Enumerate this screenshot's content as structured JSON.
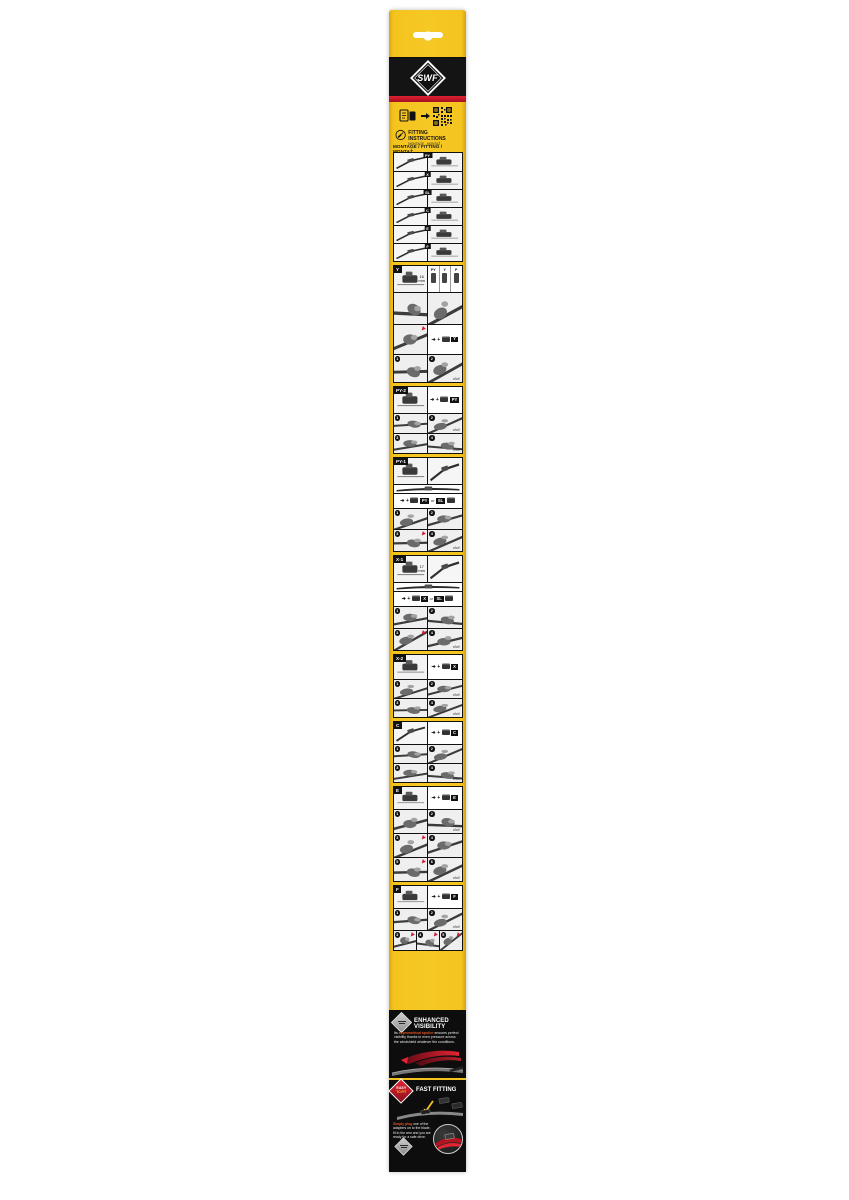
{
  "brand": "SWF",
  "colors": {
    "yellow": "#F4C41E",
    "red": "#D21E2E",
    "black": "#141414",
    "orange_highlight": "#E8541D"
  },
  "top": {
    "fitting_instructions": "FITTING INSTRUCTIONS",
    "fitting_sub": "MONTAGE - MONTAŽ",
    "heading": "MONTAGE / FITTING / MONTAŽ"
  },
  "misc": {
    "or": "or",
    "mm": "mm",
    "click": "click!",
    "plus": "+",
    "arrow": "➔"
  },
  "overview": [
    "PY",
    "X",
    "SL",
    "C",
    "E",
    "F"
  ],
  "compare": [
    "PY",
    "Y",
    "P"
  ],
  "blocks": [
    {
      "label": "Y",
      "rows": [
        {
          "h": 26,
          "cells": [
            {
              "k": "ruler",
              "num": "16"
            },
            {
              "k": "compare"
            }
          ]
        },
        {
          "h": 32,
          "cells": [
            {
              "k": "photo"
            },
            {
              "k": "photo"
            }
          ]
        },
        {
          "h": 30,
          "cells": [
            {
              "k": "photo",
              "warn": true
            },
            {
              "k": "formula",
              "main": "Y"
            }
          ]
        },
        {
          "h": 28,
          "cells": [
            {
              "k": "photo",
              "s": "1"
            },
            {
              "k": "photo",
              "s": "2",
              "click": true
            }
          ]
        }
      ]
    },
    {
      "label": "PY-2",
      "rows": [
        {
          "h": 26,
          "cells": [
            {
              "k": "adapter"
            },
            {
              "k": "formula",
              "main": "PY"
            }
          ]
        },
        {
          "h": 20,
          "cells": [
            {
              "k": "photo",
              "s": "1"
            },
            {
              "k": "photo",
              "s": "2",
              "click": true
            }
          ]
        },
        {
          "h": 20,
          "cells": [
            {
              "k": "photo",
              "s": "3"
            },
            {
              "k": "photo",
              "s": "4",
              "click": true
            }
          ]
        }
      ]
    },
    {
      "label": "PY-1",
      "rows": [
        {
          "h": 26,
          "cells": [
            {
              "k": "adapter"
            },
            {
              "k": "arm"
            }
          ]
        },
        {
          "h": 9,
          "cells": [
            {
              "k": "blade"
            }
          ]
        },
        {
          "h": 15,
          "cells": [
            {
              "k": "formula",
              "main": "PY",
              "alt": "SL"
            }
          ]
        },
        {
          "h": 21,
          "cells": [
            {
              "k": "photo",
              "s": "1"
            },
            {
              "k": "photo",
              "s": "2"
            }
          ]
        },
        {
          "h": 22,
          "cells": [
            {
              "k": "photo",
              "s": "3",
              "warn": true
            },
            {
              "k": "photo",
              "s": "4",
              "click": true
            }
          ]
        }
      ]
    },
    {
      "label": "X-1",
      "rows": [
        {
          "h": 26,
          "cells": [
            {
              "k": "ruler",
              "num": "17"
            },
            {
              "k": "arm"
            }
          ]
        },
        {
          "h": 9,
          "cells": [
            {
              "k": "blade"
            }
          ]
        },
        {
          "h": 15,
          "cells": [
            {
              "k": "formula",
              "main": "X",
              "alt": "SL"
            }
          ]
        },
        {
          "h": 22,
          "cells": [
            {
              "k": "photo",
              "s": "1"
            },
            {
              "k": "photo",
              "s": "2"
            }
          ]
        },
        {
          "h": 22,
          "cells": [
            {
              "k": "photo",
              "s": "3",
              "warn": true
            },
            {
              "k": "photo",
              "s": "4",
              "click": true
            }
          ]
        }
      ]
    },
    {
      "label": "X-2",
      "rows": [
        {
          "h": 24,
          "cells": [
            {
              "k": "adapter"
            },
            {
              "k": "formula",
              "main": "X"
            }
          ]
        },
        {
          "h": 19,
          "cells": [
            {
              "k": "photo",
              "s": "1"
            },
            {
              "k": "photo",
              "s": "2",
              "click": true
            }
          ]
        },
        {
          "h": 19,
          "cells": [
            {
              "k": "photo",
              "s": "3"
            },
            {
              "k": "photo",
              "s": "4",
              "click": true
            }
          ]
        }
      ]
    },
    {
      "label": "C",
      "rows": [
        {
          "h": 22,
          "cells": [
            {
              "k": "arm"
            },
            {
              "k": "formula",
              "main": "C"
            }
          ]
        },
        {
          "h": 19,
          "cells": [
            {
              "k": "photo",
              "s": "1"
            },
            {
              "k": "photo",
              "s": "2"
            }
          ]
        },
        {
          "h": 19,
          "cells": [
            {
              "k": "photo",
              "s": "3"
            },
            {
              "k": "photo",
              "s": "4",
              "click": true
            }
          ]
        }
      ]
    },
    {
      "label": "E",
      "rows": [
        {
          "h": 22,
          "cells": [
            {
              "k": "adapter"
            },
            {
              "k": "formula",
              "main": "E"
            }
          ]
        },
        {
          "h": 24,
          "cells": [
            {
              "k": "photo",
              "s": "1"
            },
            {
              "k": "photo",
              "s": "2",
              "click": true
            }
          ]
        },
        {
          "h": 24,
          "cells": [
            {
              "k": "photo",
              "s": "3",
              "warn": true
            },
            {
              "k": "photo",
              "s": "4"
            }
          ]
        },
        {
          "h": 24,
          "cells": [
            {
              "k": "photo",
              "s": "5",
              "warn": true
            },
            {
              "k": "photo",
              "s": "6",
              "click": true
            }
          ]
        }
      ]
    },
    {
      "label": "F",
      "rows": [
        {
          "h": 22,
          "cells": [
            {
              "k": "adapter"
            },
            {
              "k": "formula",
              "main": "F"
            }
          ]
        },
        {
          "h": 22,
          "cells": [
            {
              "k": "photo",
              "s": "1"
            },
            {
              "k": "photo",
              "s": "2",
              "click": true
            }
          ]
        },
        {
          "h": 20,
          "cells": [
            {
              "k": "photo",
              "s": "3",
              "warn": true
            },
            {
              "k": "photo",
              "s": "4",
              "warn": true
            },
            {
              "k": "photo",
              "s": "5",
              "warn": true
            }
          ]
        }
      ]
    }
  ],
  "enhanced": {
    "title": "ENHANCED VISIBILITY",
    "lead": "Its ",
    "highlight": "asymmetrical spoiler",
    "rest": " ensures perfect visibility thanks to even pressure across the windshield whatever the conditions."
  },
  "fast": {
    "badge_top": "EASY",
    "badge_bottom": "TO FIT",
    "title": "FAST FITTING",
    "highlight": "Simply plug",
    "rest": " one of the adapters on to the blade, fit to the arm and you are ready for a safe drive."
  },
  "footer": {
    "text": "SWF a brand belonging to",
    "logo": "Valeo"
  }
}
